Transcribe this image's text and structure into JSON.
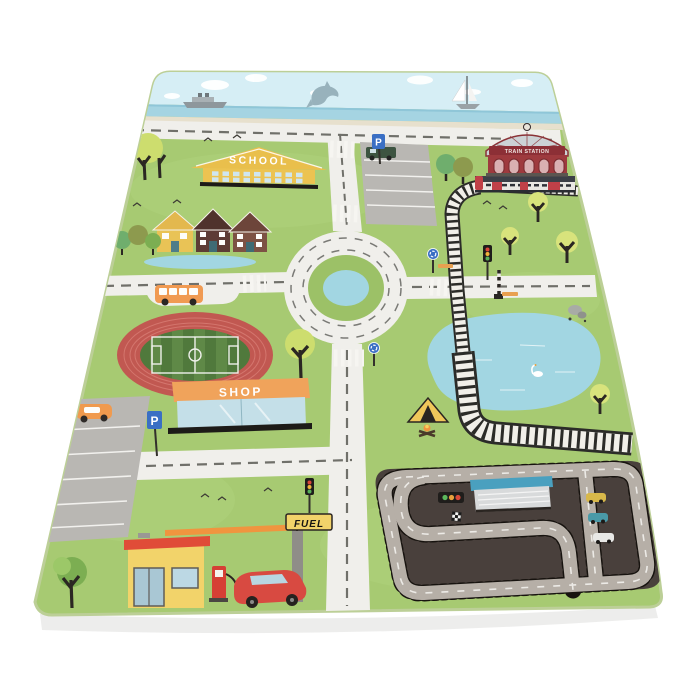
{
  "labels": {
    "school": "SCHOOL",
    "shop": "SHOP",
    "fuel": "FUEL",
    "train_station": "TRAIN STATION",
    "parking": "P"
  },
  "colors": {
    "background": "#ffffff",
    "mat_green": "#a7ca72",
    "mat_edge": "#bccf97",
    "sky": "#d6eef5",
    "sea": "#a5d4e2",
    "sand": "#e7e0cd",
    "road": "#f0efeb",
    "road_dash": "#70706a",
    "parking_gray": "#b9b7b3",
    "asphalt": "#49403c",
    "race_track_gray": "#b6afa7",
    "run_track_red": "#c15851",
    "infield_green": "#50793c",
    "pond_blue": "#a2d6e2",
    "school_yellow": "#ecc351",
    "shop_orange": "#f0a35b",
    "station_red": "#9e3a3e",
    "fuel_yellow": "#f2d36a",
    "sign_blue": "#3a6fc4",
    "rail_white": "#f1efe9",
    "bus_orange": "#f09a52",
    "car_red": "#d84a41"
  }
}
